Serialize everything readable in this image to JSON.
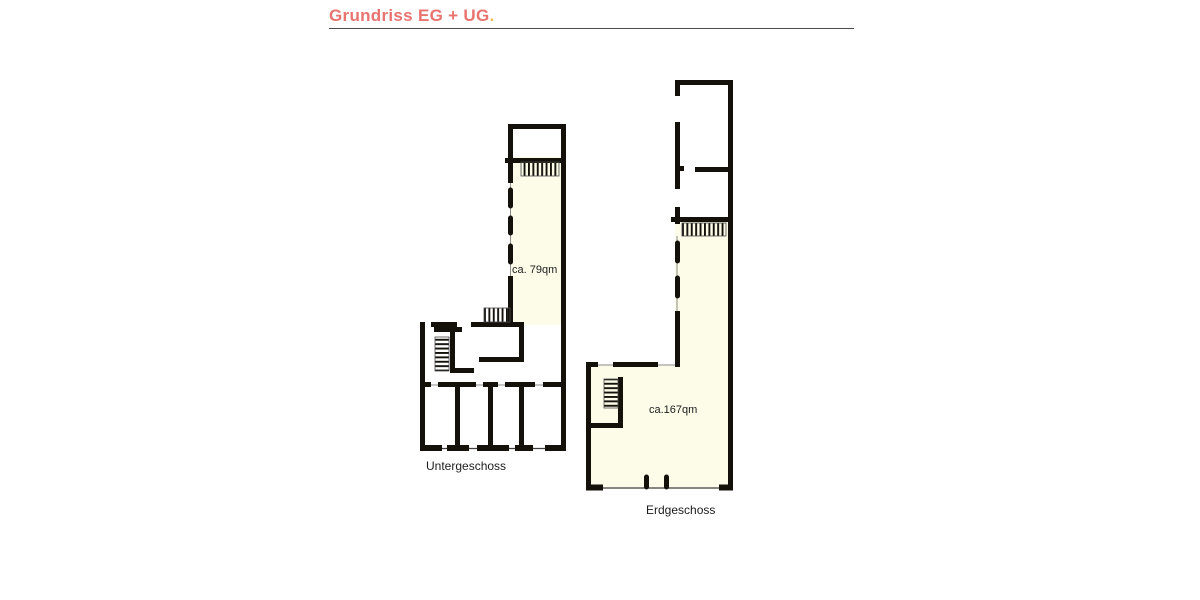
{
  "header": {
    "title": "Grundriss EG + UG",
    "title_dot": "."
  },
  "plans": {
    "untergeschoss": {
      "label": "Untergeschoss",
      "area": "ca. 79qm"
    },
    "erdgeschoss": {
      "label": "Erdgeschoss",
      "area": "ca.167qm"
    }
  },
  "colors": {
    "accent": "#e8736f",
    "dot": "#ecc04c",
    "wall": "#14110b",
    "room_fill": "#fcfce9",
    "rule": "#4a4a4a",
    "label": "#1c1c1c"
  }
}
